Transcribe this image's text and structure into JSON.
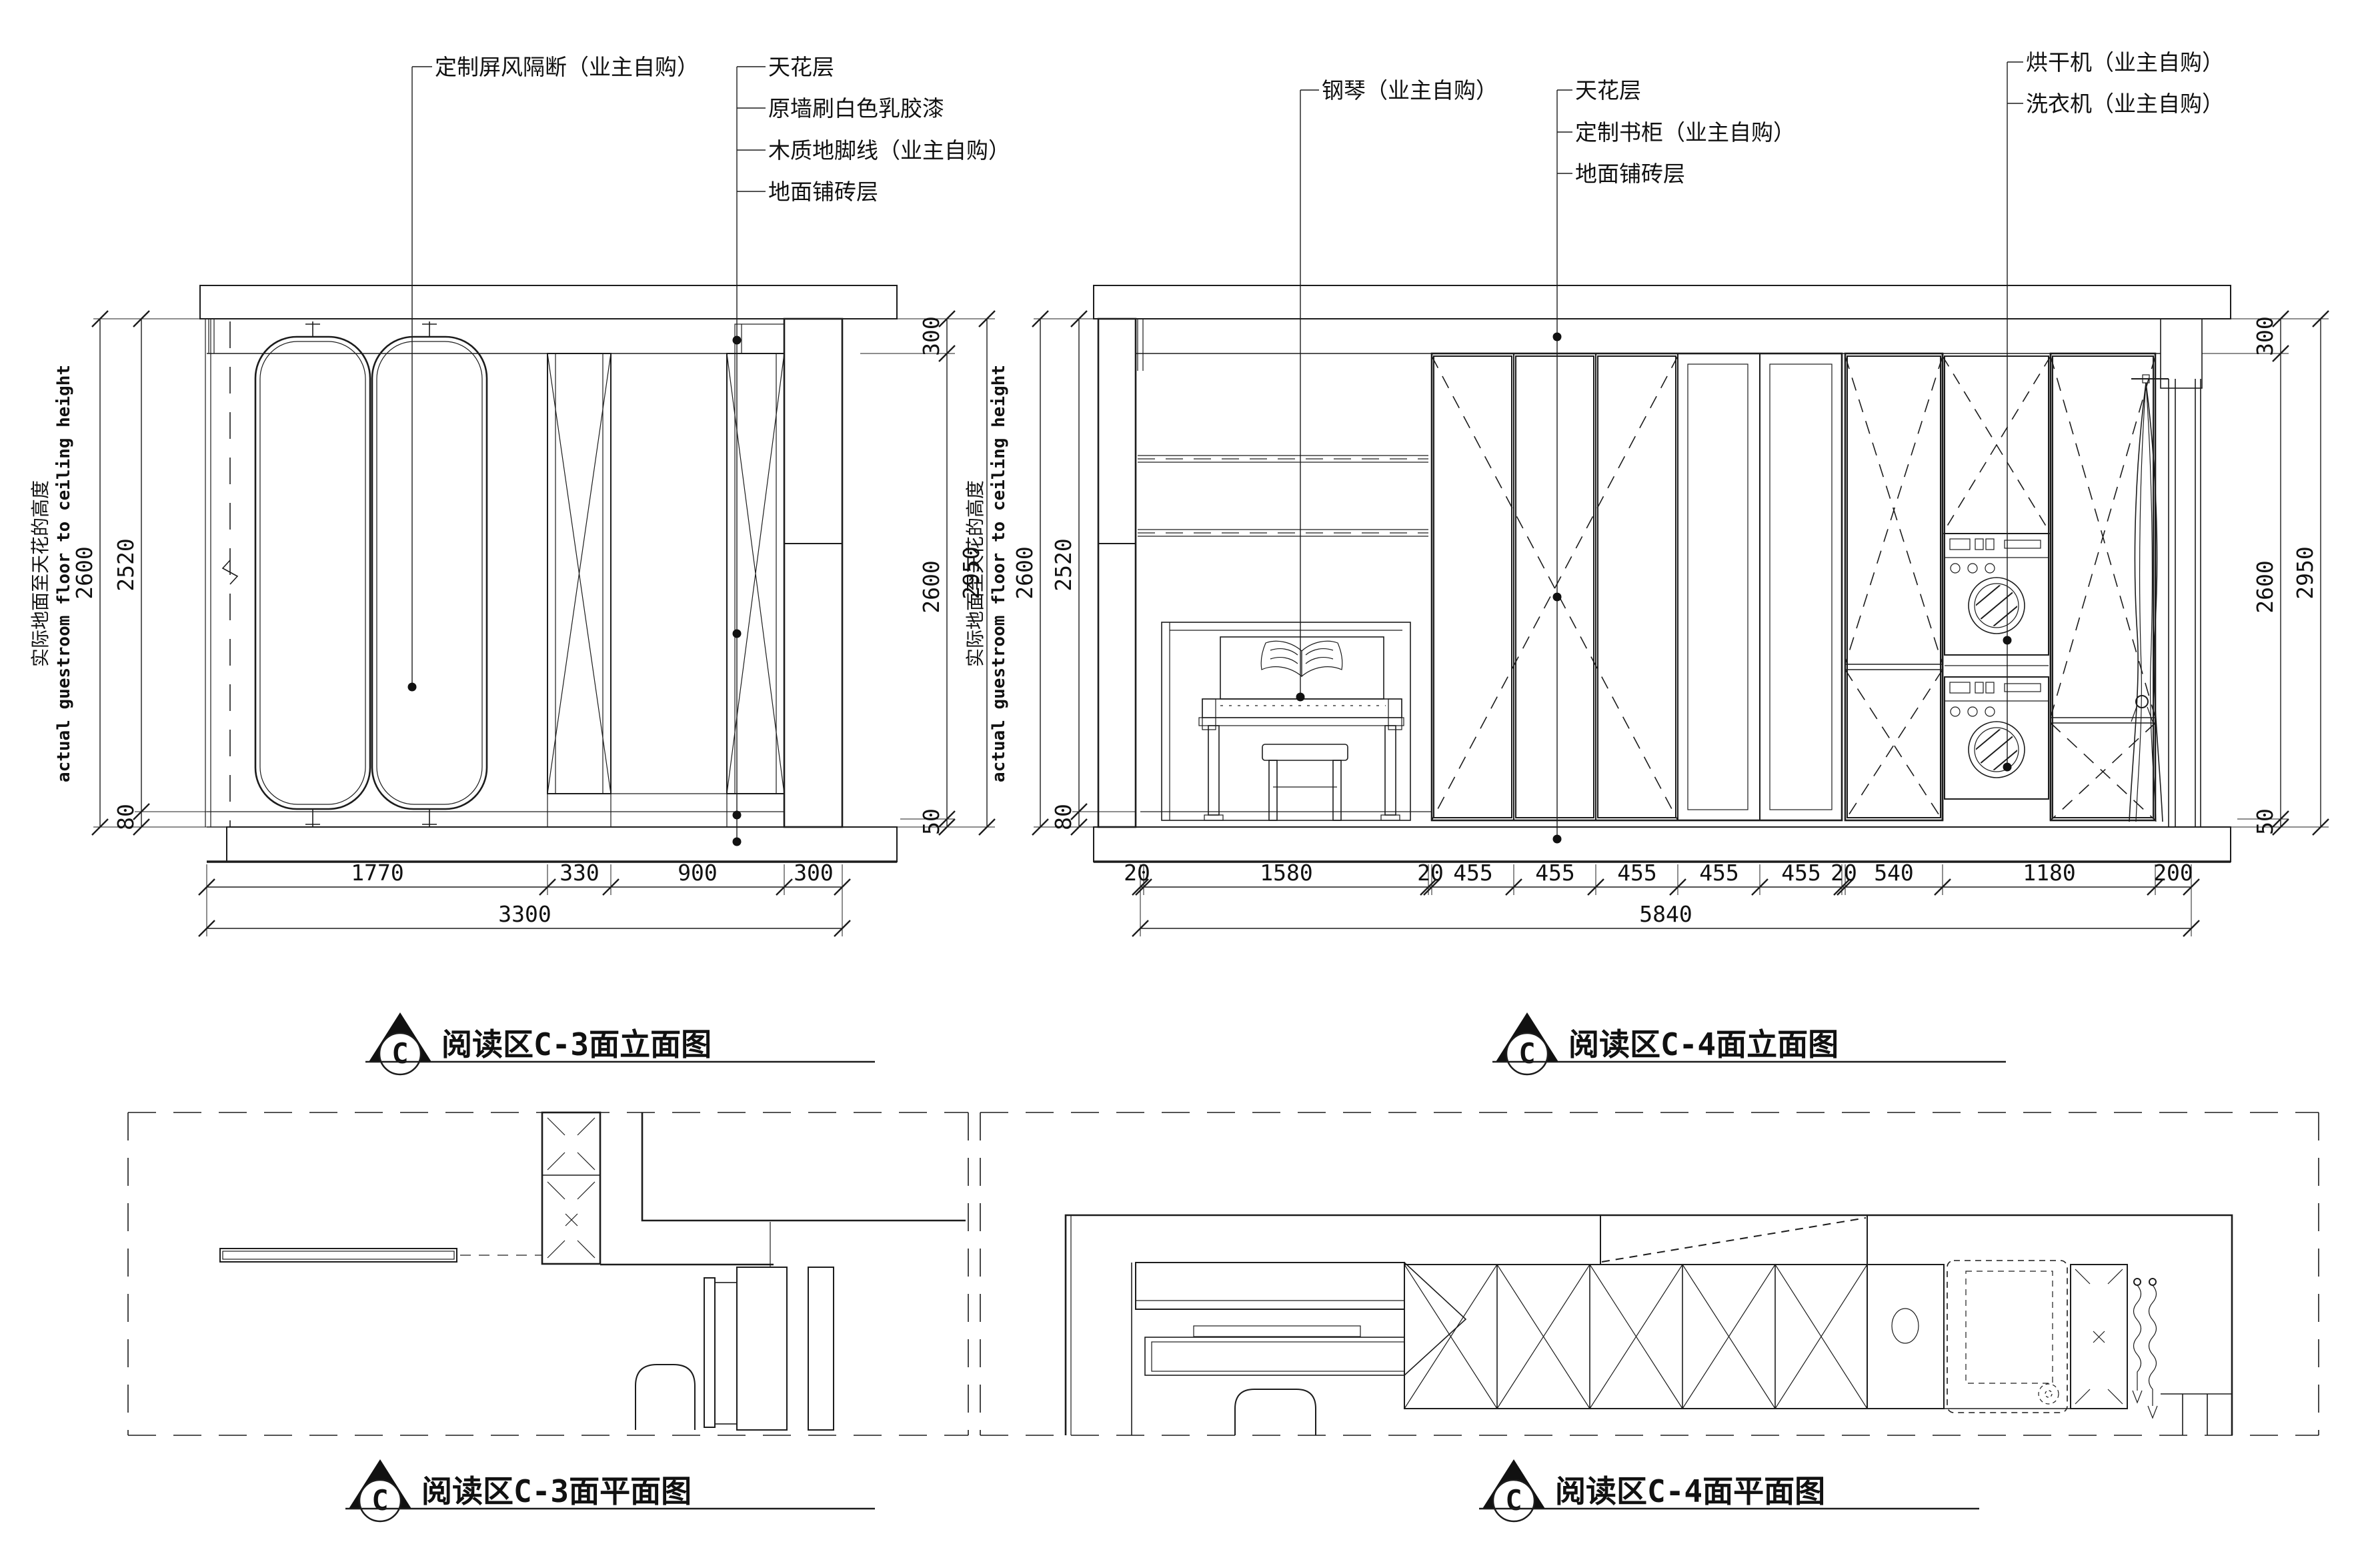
{
  "sheet": {
    "type": "interior elevation and plan CAD sheet",
    "background": "#ffffff",
    "line_color": "#1c1c1c"
  },
  "c3_elevation": {
    "title": "阅读区C-3面立面图",
    "symbol_letter": "C",
    "callout_screen": "定制屏风隔断（业主自购）",
    "callouts_right": [
      "天花层",
      "原墙刷白色乳胶漆",
      "木质地脚线（业主自购）",
      "地面铺砖层"
    ],
    "dims": {
      "left": [
        "2600",
        "2520",
        "80"
      ],
      "right": [
        "300",
        "2600",
        "50",
        "2950"
      ],
      "bottom": [
        "1770",
        "330",
        "900",
        "300"
      ],
      "total": "3300"
    },
    "side_label_cn": "实际地面至天花的高度",
    "side_label_en": "actual guestroom floor to ceiling height"
  },
  "c4_elevation": {
    "title": "阅读区C-4面立面图",
    "symbol_letter": "C",
    "callout_piano": "钢琴（业主自购）",
    "callouts_mid": [
      "天花层",
      "定制书柜（业主自购）",
      "地面铺砖层"
    ],
    "callouts_right": [
      "烘干机（业主自购）",
      "洗衣机（业主自购）"
    ],
    "dims": {
      "left": [
        "2600",
        "2520",
        "80"
      ],
      "right": [
        "300",
        "2600",
        "50",
        "2950"
      ],
      "bottom": [
        "20",
        "1580",
        "20",
        "455",
        "455",
        "455",
        "455",
        "455",
        "20",
        "540",
        "1180",
        "200"
      ],
      "total": "5840"
    },
    "side_label_cn": "实际地面至天花的高度",
    "side_label_en": "actual guestroom floor to ceiling height"
  },
  "c3_plan": {
    "title": "阅读区C-3面平面图",
    "symbol_letter": "C"
  },
  "c4_plan": {
    "title": "阅读区C-4面平面图",
    "symbol_letter": "C"
  }
}
